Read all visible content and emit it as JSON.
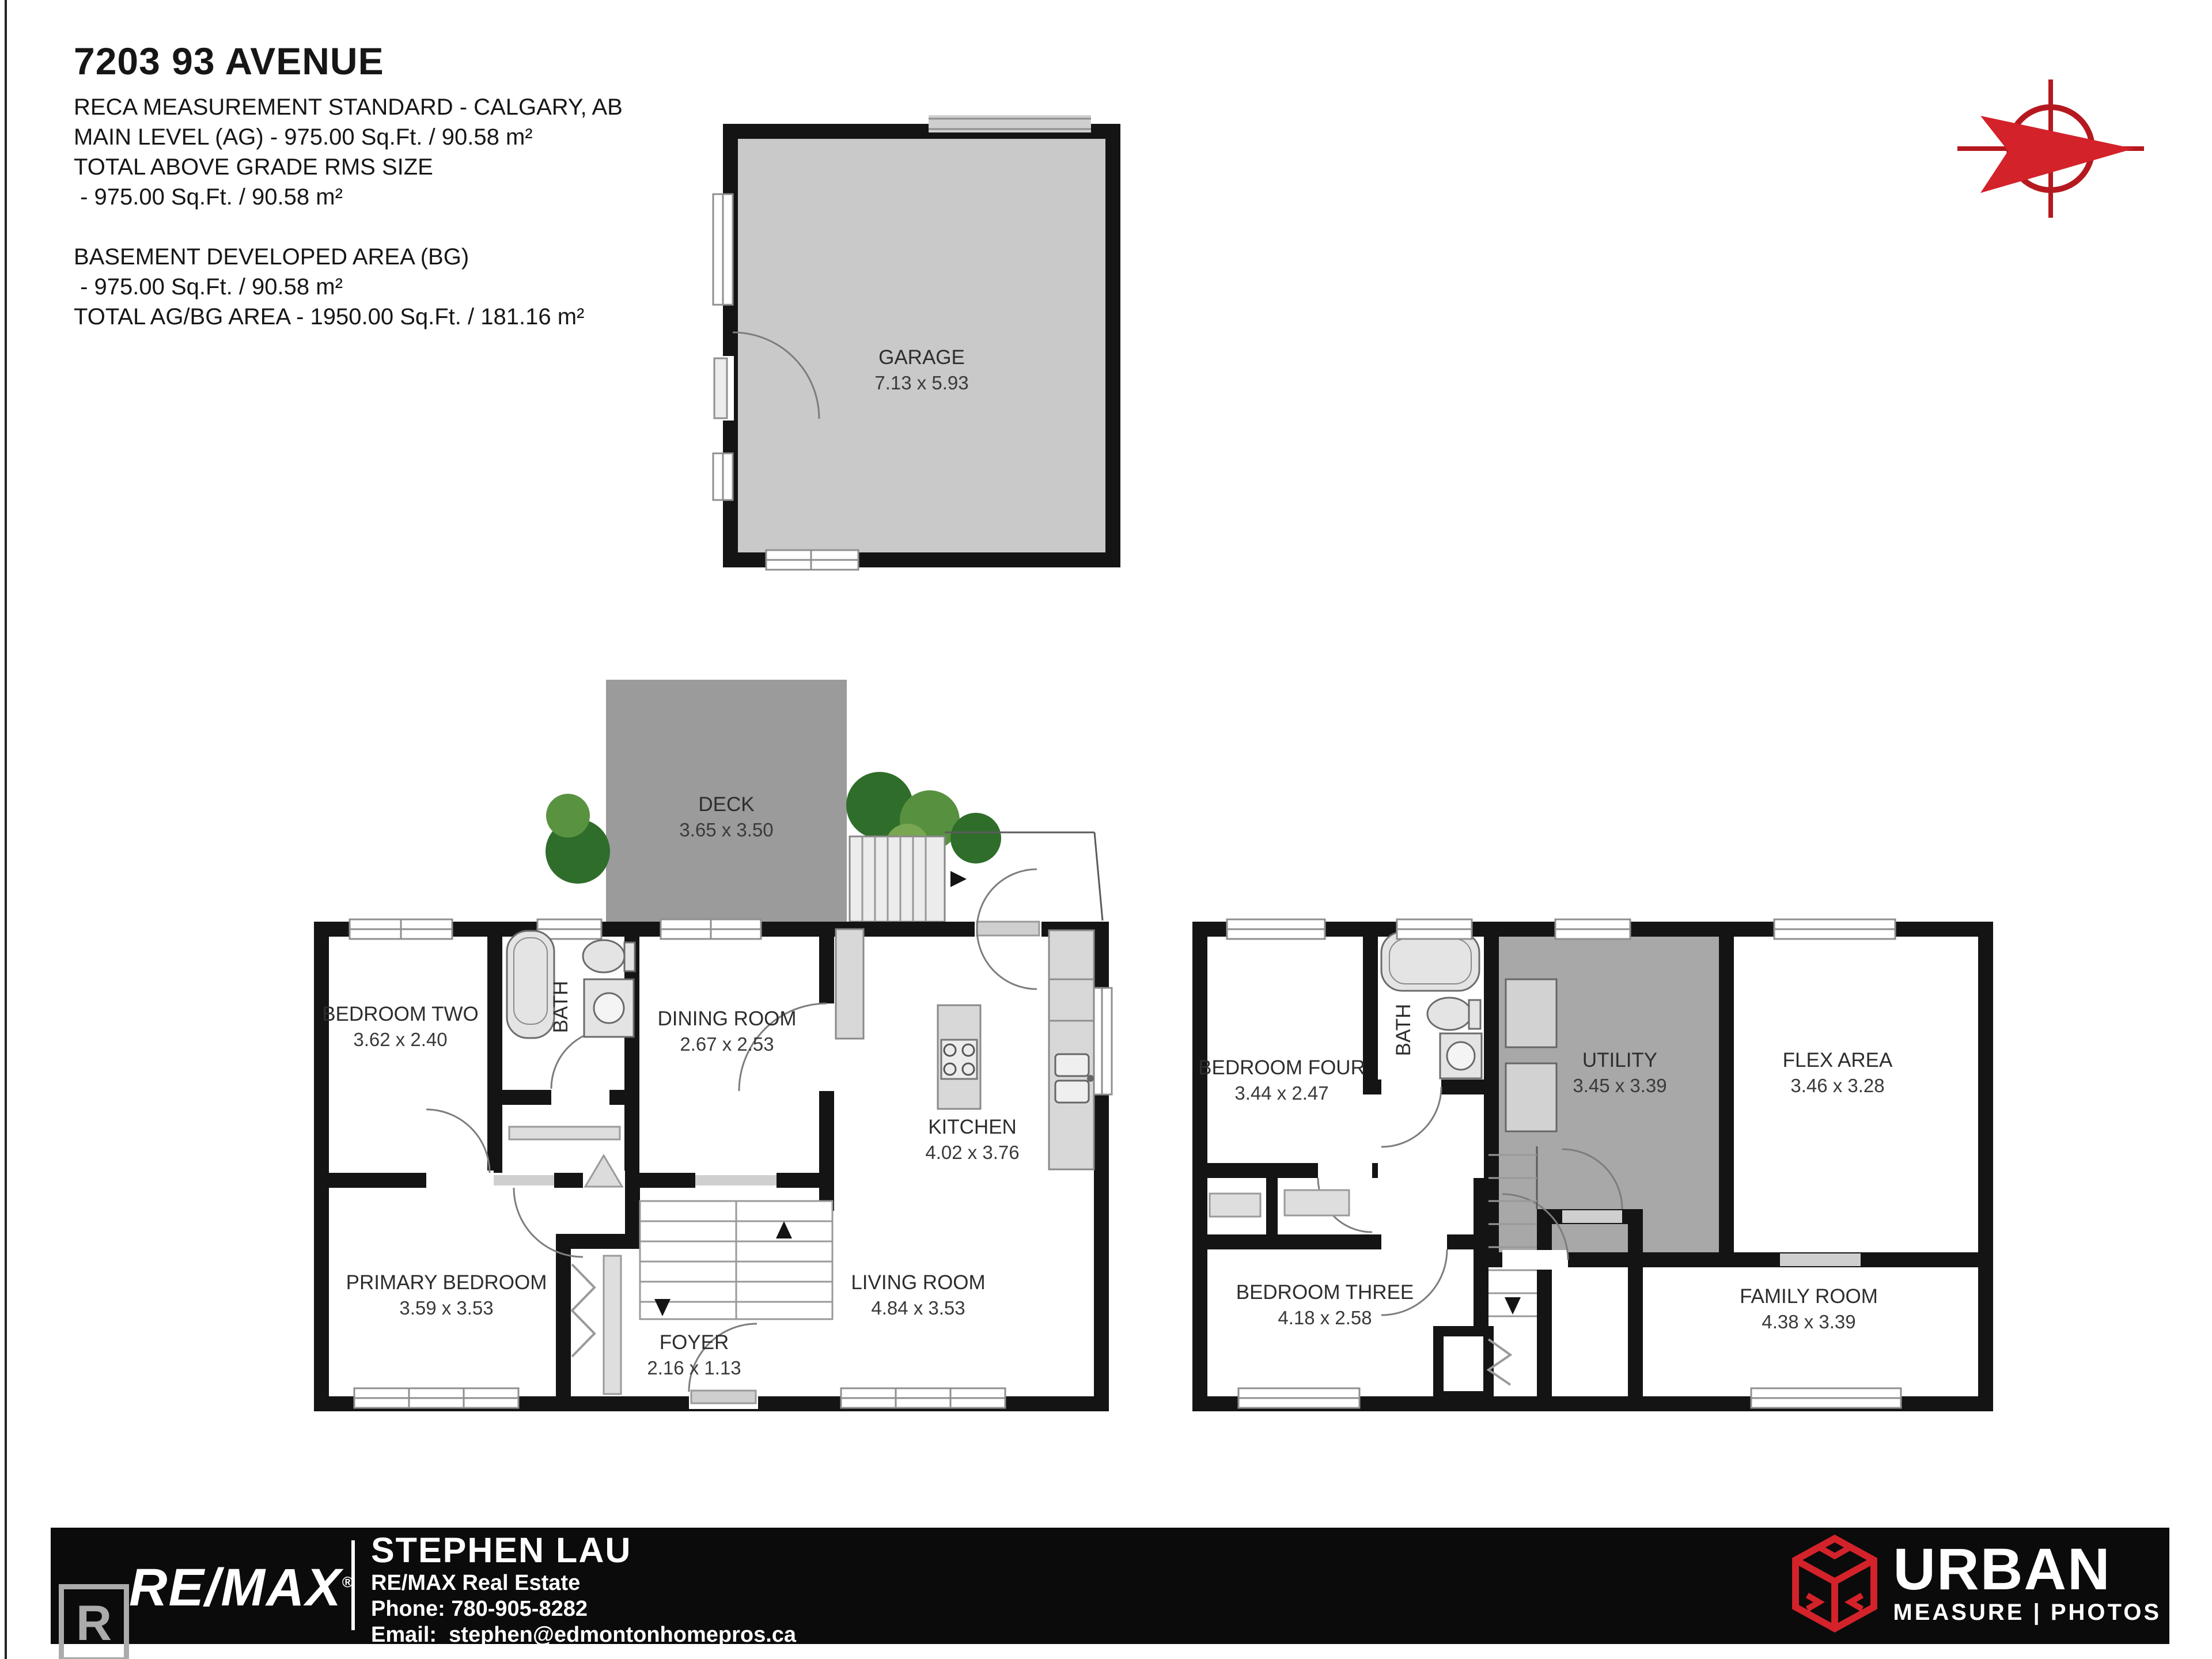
{
  "header": {
    "title": "7203 93 AVENUE",
    "lines": [
      "RECA MEASUREMENT STANDARD - CALGARY, AB",
      "MAIN LEVEL (AG) - 975.00 Sq.Ft. / 90.58 m²",
      "TOTAL ABOVE GRADE RMS SIZE",
      " - 975.00 Sq.Ft. / 90.58 m²",
      "BASEMENT DEVELOPED AREA (BG)",
      " - 975.00 Sq.Ft. / 90.58 m²",
      "TOTAL AG/BG AREA - 1950.00 Sq.Ft. / 181.16 m²"
    ]
  },
  "garage": {
    "name": "GARAGE",
    "dims": "7.13 x 5.93"
  },
  "deck": {
    "name": "DECK",
    "dims": "3.65 x 3.50"
  },
  "main_level": {
    "rooms": [
      {
        "name": "BEDROOM TWO",
        "dims": "3.62 x 2.40"
      },
      {
        "name": "BATH"
      },
      {
        "name": "DINING ROOM",
        "dims": "2.67 x 2.53"
      },
      {
        "name": "KITCHEN",
        "dims": "4.02 x 3.76"
      },
      {
        "name": "LIVING ROOM",
        "dims": "4.84 x 3.53"
      },
      {
        "name": "PRIMARY BEDROOM",
        "dims": "3.59 x 3.53"
      },
      {
        "name": "FOYER",
        "dims": "2.16 x 1.13"
      }
    ]
  },
  "basement": {
    "rooms": [
      {
        "name": "BEDROOM FOUR",
        "dims": "3.44 x 2.47"
      },
      {
        "name": "BATH"
      },
      {
        "name": "UTILITY",
        "dims": "3.45 x 3.39"
      },
      {
        "name": "FLEX AREA",
        "dims": "3.46 x 3.28"
      },
      {
        "name": "BEDROOM THREE",
        "dims": "4.18 x 2.58"
      },
      {
        "name": "FAMILY ROOM",
        "dims": "4.38 x 3.39"
      }
    ]
  },
  "footer": {
    "remax_wordmark": "RE/MAX",
    "registered_mark": "®",
    "realtor_letter": "R",
    "realtor_caption": "REALTOR®",
    "agent_name": "STEPHEN LAU",
    "company": "RE/MAX Real Estate",
    "phone_label": "Phone:",
    "phone_number": "780-905-8282",
    "email_label": "Email:",
    "email_address": "stephen@edmontonhomepros.ca",
    "brand": {
      "title": "URBAN",
      "subtitle": "MEASURE | PHOTOS"
    }
  },
  "colors": {
    "wall": "#141414",
    "garage_fill": "#c9c9c9",
    "deck_fill": "#9b9b9b",
    "utility_fill": "#a8a8a8",
    "accent_red": "#d3222a",
    "footer_bg": "#0b0b0b",
    "plant_green": "#2f6d2a"
  }
}
